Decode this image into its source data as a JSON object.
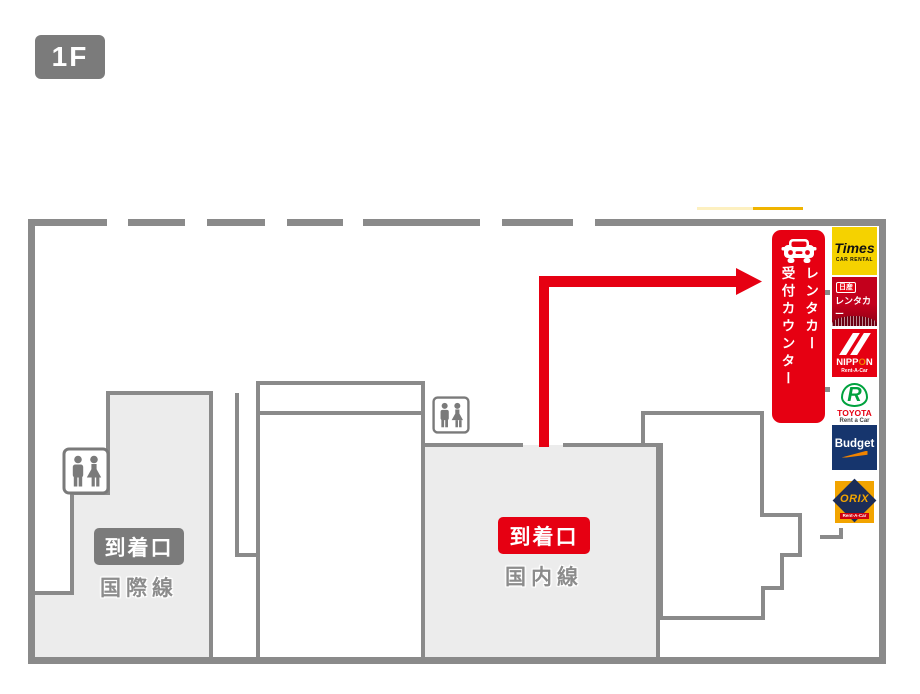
{
  "floor_label": "1F",
  "areas": {
    "international": {
      "gate_label": "到着口",
      "line_label": "国際線"
    },
    "domestic": {
      "gate_label": "到着口",
      "line_label": "国内線"
    }
  },
  "rental_counter": {
    "banner_line1": "レンタカー",
    "banner_line2": "受付カウンター"
  },
  "rental_companies": [
    {
      "id": "times",
      "title": "Times",
      "subtitle": "CAR RENTAL"
    },
    {
      "id": "nissan",
      "line1": "日産",
      "line2": "レンタカー"
    },
    {
      "id": "nippon",
      "part1": "NIPP",
      "part2": "O",
      "part3": "N",
      "subtitle": "Rent-A-Car"
    },
    {
      "id": "toyota",
      "mark": "R",
      "title": "TOYOTA",
      "subtitle": "Rent a Car"
    },
    {
      "id": "budget",
      "title": "Budget"
    },
    {
      "id": "orix",
      "title": "ORIX",
      "subtitle": "Rent-A-Car"
    }
  ],
  "colors": {
    "accent_red": "#e60012",
    "wall_gray": "#8a8a8a",
    "badge_gray": "#7b7b7b",
    "room_fill": "#ececec",
    "times_yellow": "#f5d200",
    "budget_navy": "#16356d",
    "orix_orange": "#f2a400"
  }
}
